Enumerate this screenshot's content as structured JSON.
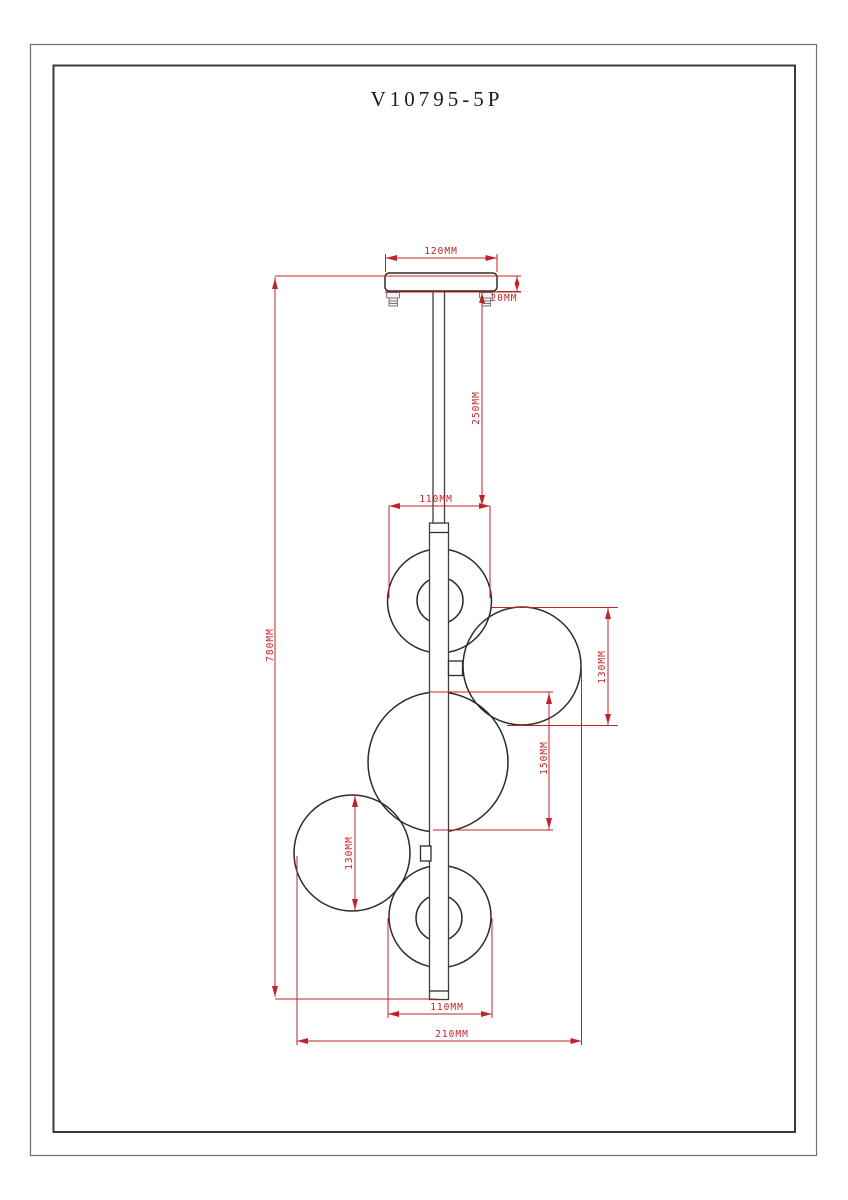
{
  "title": "V10795-5P",
  "colors": {
    "dimension_red": "#c22328",
    "outline_black": "#2b2b2b"
  },
  "dimensions": {
    "canopy_width": "120MM",
    "canopy_thickness": "20MM",
    "suspension_rod_length": "250MM",
    "top_globe_diameter": "110MM",
    "overall_drop_height": "780MM",
    "right_globe_diameter": "130MM",
    "middle_globe_diameter": "150MM",
    "left_globe_diameter": "130MM",
    "bottom_globe_diameter": "110MM",
    "overall_width": "210MM"
  }
}
